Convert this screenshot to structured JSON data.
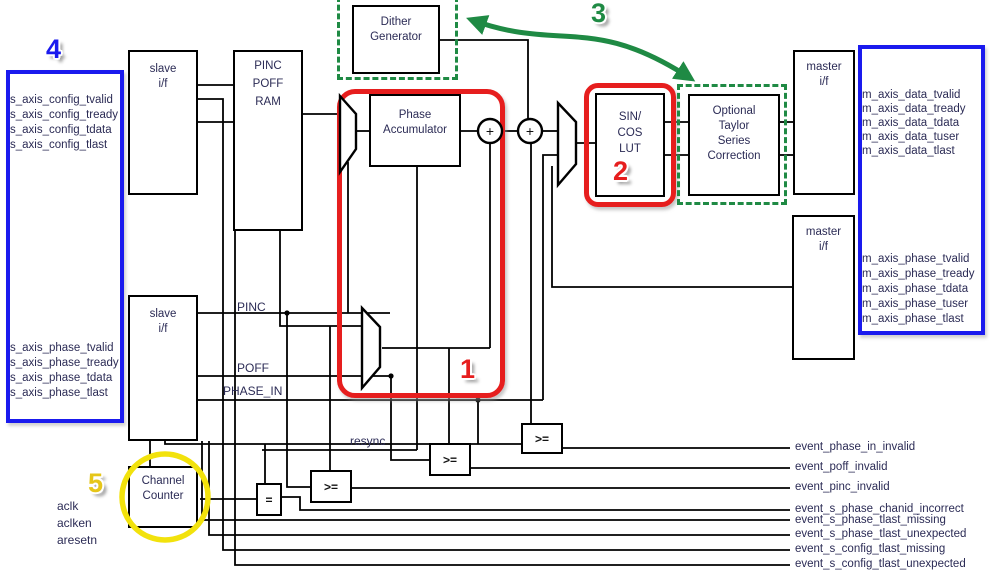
{
  "diagram_title": "DDS block diagram",
  "blocks": {
    "slave_if_config": "slave\ni/f",
    "slave_if_phase": "slave\ni/f",
    "pinc_poff_ram": "PINC\nPOFF\nRAM",
    "dither_generator": "Dither\nGenerator",
    "phase_accumulator": "Phase\nAccumulator",
    "sin_cos_lut": "SIN/\nCOS\nLUT",
    "taylor_correction": "Optional\nTaylor\nSeries\nCorrection",
    "master_if_data": "master\ni/f",
    "master_if_phase": "master\ni/f",
    "channel_counter": "Channel\nCounter"
  },
  "operators": {
    "adder": "+",
    "equals": "=",
    "gte": ">="
  },
  "wire_labels": {
    "pinc": "PINC",
    "poff": "POFF",
    "phase_in": "PHASE_IN",
    "resync": "resync"
  },
  "ports": {
    "config_in": [
      "s_axis_config_tvalid",
      "s_axis_config_tready",
      "s_axis_config_tdata",
      "s_axis_config_tlast"
    ],
    "phase_in": [
      "s_axis_phase_tvalid",
      "s_axis_phase_tready",
      "s_axis_phase_tdata",
      "s_axis_phase_tlast"
    ],
    "data_out": [
      "m_axis_data_tvalid",
      "m_axis_data_tready",
      "m_axis_data_tdata",
      "m_axis_data_tuser",
      "m_axis_data_tlast"
    ],
    "phase_out": [
      "m_axis_phase_tvalid",
      "m_axis_phase_tready",
      "m_axis_phase_tdata",
      "m_axis_phase_tuser",
      "m_axis_phase_tlast"
    ]
  },
  "clock_signals": [
    "aclk",
    "aclken",
    "aresetn"
  ],
  "events": [
    "event_phase_in_invalid",
    "event_poff_invalid",
    "event_pinc_invalid",
    "event_s_phase_chanid_incorrect",
    "event_s_phase_tlast_missing",
    "event_s_phase_tlast_unexpected",
    "event_s_config_tlast_missing",
    "event_s_config_tlast_unexpected"
  ],
  "callouts": {
    "one": "1",
    "two": "2",
    "three": "3",
    "four": "4",
    "five": "5"
  },
  "colors": {
    "highlight_red": "#e61e1e",
    "highlight_green": "#1f8a44",
    "highlight_blue": "#1a1aee",
    "highlight_yellow": "#f2e20c",
    "callout_five_yellow": "#e6c619",
    "label_text": "#2b2b55",
    "wire": "#000000",
    "background": "#ffffff"
  }
}
